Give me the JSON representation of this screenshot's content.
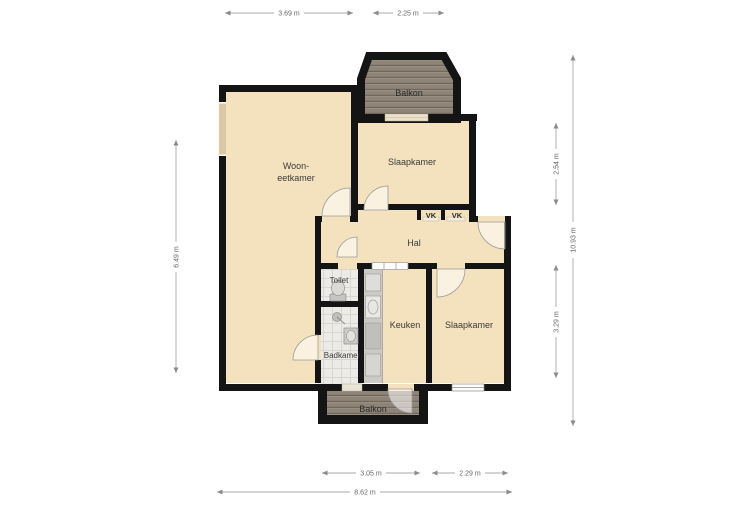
{
  "plan": {
    "rooms": {
      "woon_line1": "Woon-",
      "woon_line2": "eetkamer",
      "slaapkamer_top": "Slaapkamer",
      "slaapkamer_bottom": "Slaapkamer",
      "balkon_top": "Balkon",
      "balkon_bottom": "Balkon",
      "hal": "Hal",
      "toilet": "Toilet",
      "keuken": "Keuken",
      "badkamer": "Badkamer",
      "vk_left": "VK",
      "vk_right": "VK"
    },
    "dimensions": {
      "top_living_width": "3.69 m",
      "top_balcony_width": "2.25 m",
      "left_height": "6.49 m",
      "right_bedroom_top_height": "2.54 m",
      "right_bedroom_bottom_height": "3.29 m",
      "right_total_height": "10.93 m",
      "bottom_kitchen_width": "3.05 m",
      "bottom_bedroom_width": "2.29 m",
      "bottom_total_width": "8.62 m"
    },
    "colors": {
      "floor": "#f4e1bd",
      "wall": "#141414",
      "balcony_wood": "#8e8478",
      "tile_floor": "#ecebe7",
      "counter": "#cbcac6",
      "dimension_line": "#a8a8a8"
    }
  }
}
